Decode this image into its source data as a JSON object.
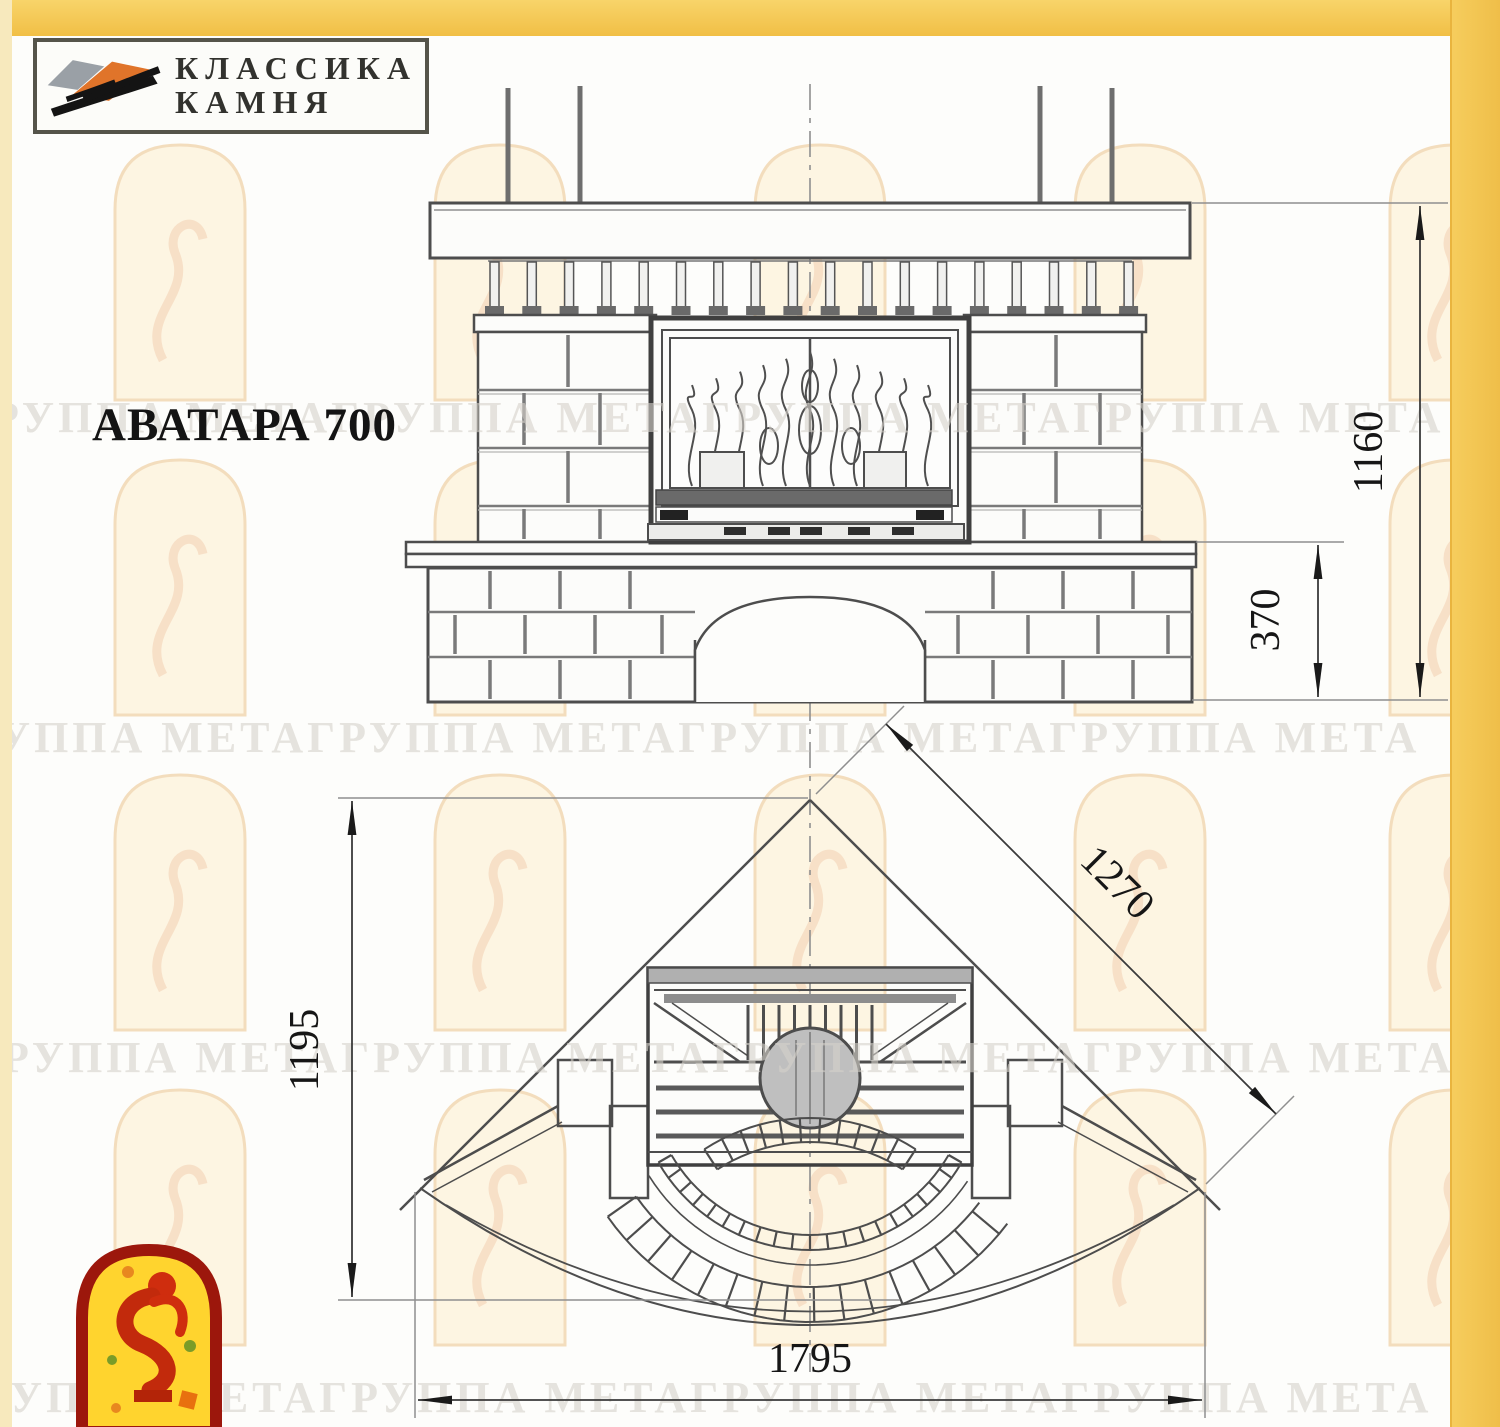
{
  "page": {
    "model_title": "АВАТАРА 700"
  },
  "brand_logo": {
    "icon": "stone-stack-icon",
    "line1": "КЛАССИКА",
    "line2": "КАМНЯ"
  },
  "dimensions": {
    "overall_height_mm": "1160",
    "plinth_height_mm": "370",
    "side_depth_mm": "1195",
    "diagonal_front_mm": "1270",
    "overall_width_mm": "1795"
  },
  "watermark": {
    "row_text": "ГРУППА МЕТАГРУППА МЕТАГРУППА МЕТАГРУППА МЕТА",
    "arch_icon": "arched-window-watermark"
  },
  "footer_logo": {
    "icon": "meta-firebird-icon"
  },
  "colors": {
    "page_border_gold": "#f2c24d",
    "drawing_line": "#4d4d4d",
    "watermark_text": "#d6d2cb",
    "watermark_fill": "#fdf5e2",
    "watermark_stroke": "#f3ddbd",
    "watermark_figure": "#f2cdb0",
    "logo_red": "#9c170c",
    "logo_yellow": "#ffd42e",
    "figure_red": "#cf2d0e",
    "stone_gray": "#9aa0a6",
    "stone_orange": "#e0742a"
  }
}
